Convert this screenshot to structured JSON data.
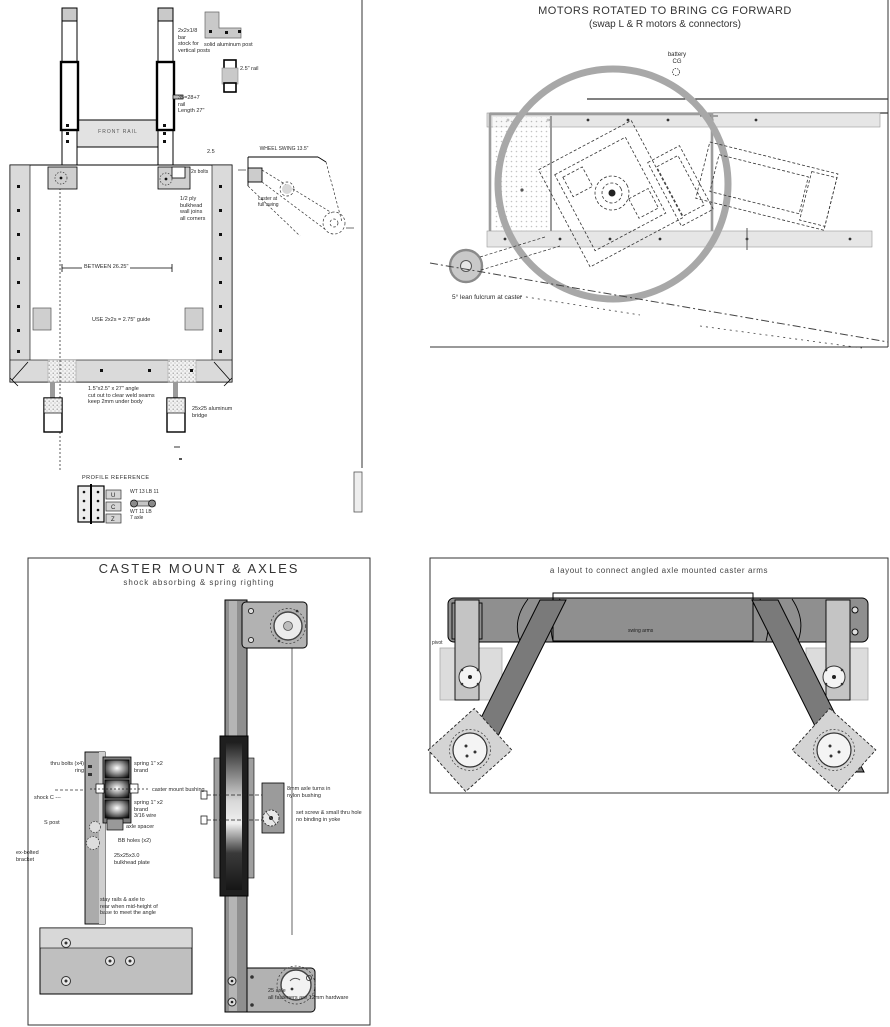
{
  "top_left": {
    "crossbar_label": "FRONT RAIL",
    "post_note": "2x2x1/8\nbar\nstock for\nvertical posts",
    "alum_post_label": "solid aluminum post",
    "clip_label": "2.5\" rail",
    "rail_note": "35=28+7\nrail\nLength 27\"",
    "dim_small": "2.5",
    "bolts_label": "2x bolts",
    "wall_note": "1/2 ply\nbulkhead\nwall joins\nall corners",
    "swing_dim": "WHEEL SWING 13.5\"",
    "swing_note": "caster at\nfull swing",
    "between_dim": "BETWEEN 26.25\"",
    "guide_note": "USE 2x2s = 2.75\" guide",
    "angle_note": "1.5\"x2.5\" x 27\" angle\ncut out to clear weld seams\nkeep 2mm under body",
    "bridge_label": "25x25 aluminum\nbridge",
    "legend": {
      "title": "PROFILE REFERENCE",
      "tabs": [
        "U",
        "C",
        "Z"
      ],
      "wt1": "WT 13 LB 11",
      "wt2": "WT 11 LB\n7 axle"
    }
  },
  "top_right": {
    "title_line1": "MOTORS ROTATED TO BRING CG FORWARD",
    "title_line2": "(swap L & R motors & connectors)",
    "battery_label": "battery\nCG",
    "caster_note": "5° lean fulcrum at caster"
  },
  "bottom_left": {
    "title": "CASTER MOUNT & AXLES",
    "subtitle": "shock absorbing & spring righting",
    "labels": {
      "left1": "thru bolts (x4)\nring",
      "left2": "shock C ---",
      "left3": "S post",
      "left4": "ex-bolted\nbracket",
      "right1": "spring 1\" x2\nbrand",
      "right2": "caster mount bushing",
      "right3": "spring 1\" x2\nbrand\n3/16 wire",
      "right4": "axle spacer",
      "right5": "BB holes (x2)",
      "right6": "25x25x3.0\nbulkhead plate",
      "axle1": "8mm axle turns in\nnylon bushing",
      "axle2": "set screw & small thru hole\nno binding in yoke",
      "note": "stay rails & axle to\nrear when mid-height of\nbase to meet the angle",
      "bottom": "25 axle\nall fasteners are 12mm hardware"
    }
  },
  "bottom_right": {
    "title": "a layout to connect angled axle mounted caster arms",
    "arm_label": "swing arms",
    "pivot_label": "pivot"
  },
  "colors": {
    "wheel_ring": "#a8a8a8",
    "light_gray": "#e2e2e2",
    "mid_gray": "#b2b2b2",
    "arm_gray": "#7a7a7a",
    "line_black": "#1a1a1a"
  }
}
